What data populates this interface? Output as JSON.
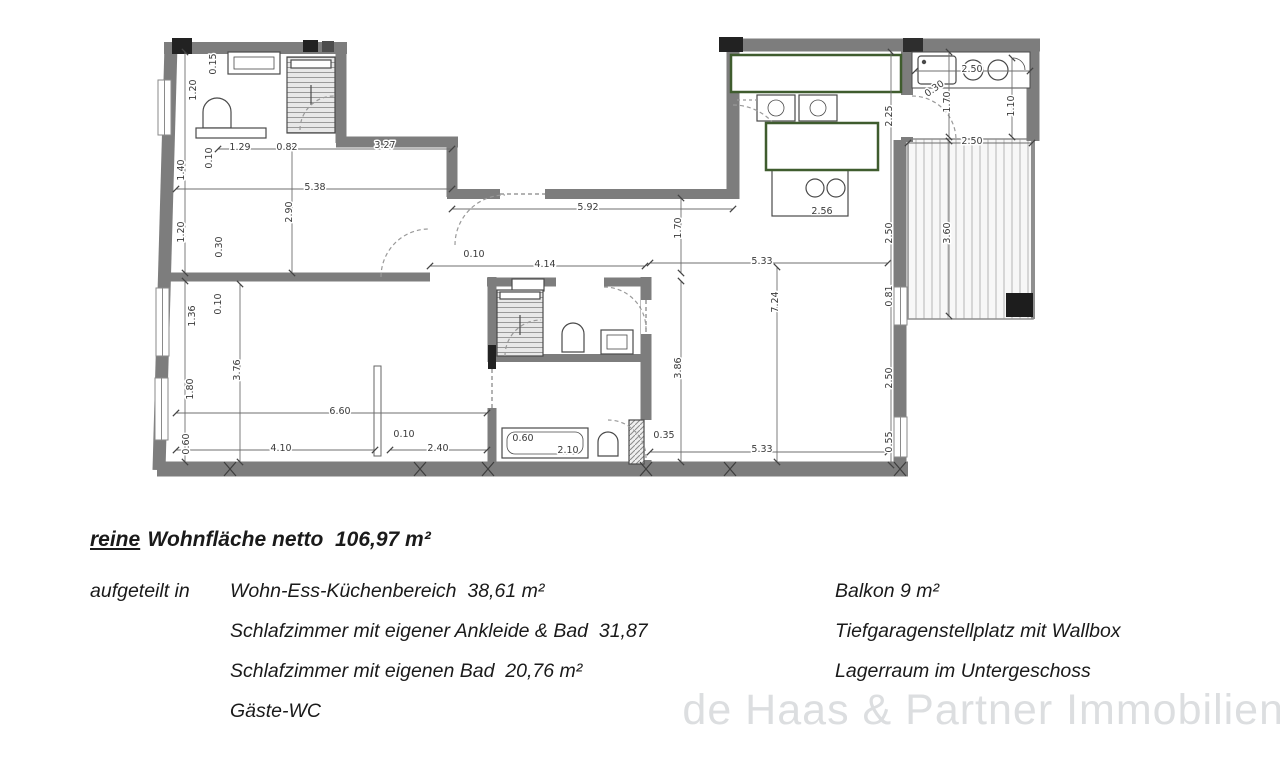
{
  "summary": {
    "prefix": "reine",
    "rest": "Wohnfläche netto  106,97 m²"
  },
  "breakdown": {
    "label": "aufgeteilt in",
    "left": [
      "Wohn-Ess-Küchenbereich  38,61 m²",
      "Schlafzimmer mit eigener Ankleide & Bad  31,87",
      "Schlafzimmer mit eigenen Bad  20,76 m²",
      "Gäste-WC"
    ],
    "right": [
      "Balkon 9 m²",
      "Tiefgaragenstellplatz mit Wallbox",
      "Lagerraum im Untergeschoss"
    ]
  },
  "watermark": "de Haas & Partner Immobilien",
  "floorplan": {
    "colors": {
      "wall": "#7d7d7d",
      "fixture_line": "#4a4a4a",
      "redaction_border": "#3f5c2e",
      "dim_text": "#3a3a3a",
      "balcony_stripe": "#c9c9c9"
    },
    "dim_labels": [
      {
        "t": "0.15",
        "x": 216,
        "y": 64,
        "r": -90
      },
      {
        "t": "1.20",
        "x": 196,
        "y": 90,
        "r": -90
      },
      {
        "t": "1.40",
        "x": 184,
        "y": 170,
        "r": -90
      },
      {
        "t": "1.20",
        "x": 184,
        "y": 232,
        "r": -90
      },
      {
        "t": "0.10",
        "x": 212,
        "y": 158,
        "r": -90
      },
      {
        "t": "0.30",
        "x": 222,
        "y": 247,
        "r": -90
      },
      {
        "t": "1.29",
        "x": 240,
        "y": 150,
        "r": 0
      },
      {
        "t": "0.82",
        "x": 287,
        "y": 150,
        "r": 0
      },
      {
        "t": "3.27",
        "x": 385,
        "y": 148,
        "r": 0
      },
      {
        "t": "5.38",
        "x": 315,
        "y": 190,
        "r": 0
      },
      {
        "t": "2.90",
        "x": 292,
        "y": 212,
        "r": -90
      },
      {
        "t": "5.92",
        "x": 588,
        "y": 210,
        "r": 0
      },
      {
        "t": "0.10",
        "x": 474,
        "y": 257,
        "r": 0
      },
      {
        "t": "4.14",
        "x": 545,
        "y": 267,
        "r": 0
      },
      {
        "t": "1.70",
        "x": 681,
        "y": 228,
        "r": -90
      },
      {
        "t": "5.33",
        "x": 762,
        "y": 264,
        "r": 0
      },
      {
        "t": "7.24",
        "x": 778,
        "y": 302,
        "r": -90
      },
      {
        "t": "3.86",
        "x": 681,
        "y": 368,
        "r": -90
      },
      {
        "t": "5.33",
        "x": 762,
        "y": 452,
        "r": 0
      },
      {
        "t": "0.10",
        "x": 221,
        "y": 304,
        "r": -90
      },
      {
        "t": "1.36",
        "x": 195,
        "y": 316,
        "r": -90
      },
      {
        "t": "3.76",
        "x": 240,
        "y": 370,
        "r": -90
      },
      {
        "t": "1.80",
        "x": 193,
        "y": 389,
        "r": -90
      },
      {
        "t": "0.60",
        "x": 189,
        "y": 444,
        "r": -90
      },
      {
        "t": "6.60",
        "x": 340,
        "y": 414,
        "r": 0
      },
      {
        "t": "0.10",
        "x": 404,
        "y": 437,
        "r": 0
      },
      {
        "t": "4.10",
        "x": 281,
        "y": 451,
        "r": 0
      },
      {
        "t": "2.40",
        "x": 438,
        "y": 451,
        "r": 0
      },
      {
        "t": "0.60",
        "x": 523,
        "y": 441,
        "r": 0
      },
      {
        "t": "2.10",
        "x": 568,
        "y": 453,
        "r": 0
      },
      {
        "t": "0.35",
        "x": 664,
        "y": 438,
        "r": 0
      },
      {
        "t": "2.56",
        "x": 822,
        "y": 214,
        "r": 0
      },
      {
        "t": "2.25",
        "x": 892,
        "y": 116,
        "r": -90
      },
      {
        "t": "2.50",
        "x": 892,
        "y": 233,
        "r": -90
      },
      {
        "t": "0.81",
        "x": 892,
        "y": 296,
        "r": -90
      },
      {
        "t": "2.50",
        "x": 892,
        "y": 378,
        "r": -90
      },
      {
        "t": "0.55",
        "x": 892,
        "y": 442,
        "r": -90
      },
      {
        "t": "2.50",
        "x": 972,
        "y": 72,
        "r": 0
      },
      {
        "t": "0.30",
        "x": 936,
        "y": 91,
        "r": -35
      },
      {
        "t": "1.70",
        "x": 950,
        "y": 102,
        "r": -90
      },
      {
        "t": "1.10",
        "x": 1014,
        "y": 106,
        "r": -90
      },
      {
        "t": "2.50",
        "x": 972,
        "y": 144,
        "r": 0
      },
      {
        "t": "3.60",
        "x": 950,
        "y": 233,
        "r": -90
      }
    ]
  }
}
